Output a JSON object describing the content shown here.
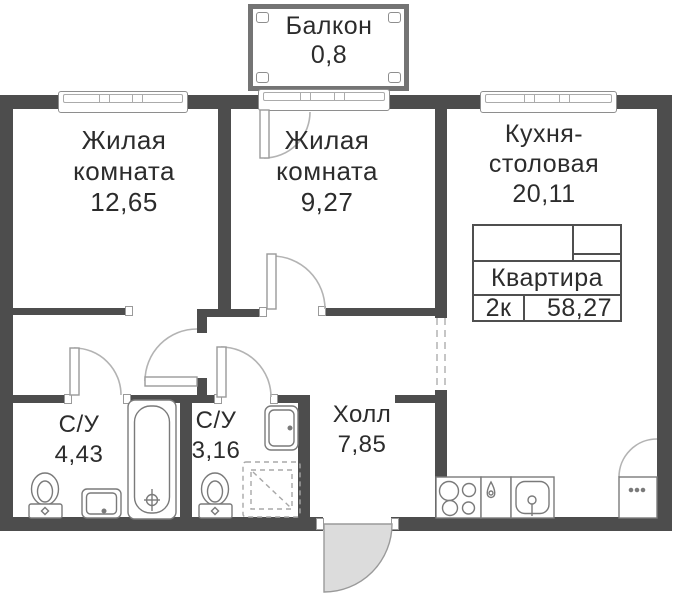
{
  "balcony": {
    "label": "Балкон",
    "area": "0,8"
  },
  "rooms": {
    "living1": {
      "name1": "Жилая",
      "name2": "комната",
      "area": "12,65"
    },
    "living2": {
      "name1": "Жилая",
      "name2": "комната",
      "area": "9,27"
    },
    "kitchen": {
      "name1": "Кухня-",
      "name2": "столовая",
      "area": "20,11"
    },
    "bath1": {
      "name": "С/У",
      "area": "4,43"
    },
    "bath2": {
      "name": "С/У",
      "area": "3,16"
    },
    "hall": {
      "name": "Холл",
      "area": "7,85"
    }
  },
  "info_table": {
    "title": "Квартира",
    "plan_type": "2к",
    "total_area": "58,27"
  },
  "colors": {
    "wall": "#4d4d4d",
    "text": "#2c2c2c",
    "door_arc": "#b3b3b3",
    "entry_door_fill": "#dcdcdc",
    "fixture_stroke": "#7a7a7a",
    "window_frame": "#8e8e8e"
  }
}
